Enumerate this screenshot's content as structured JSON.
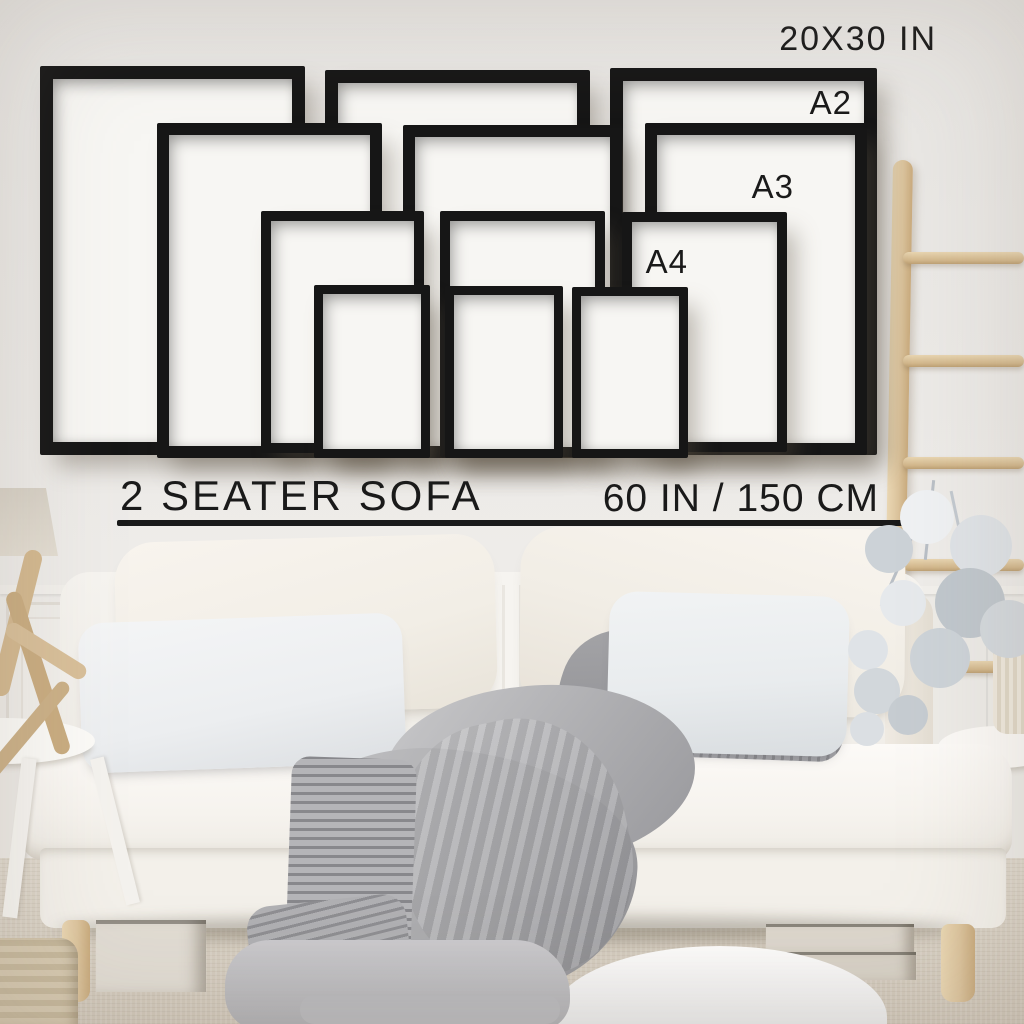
{
  "labels": {
    "frame_size_top": "20X30 IN",
    "a2": "A2",
    "a3": "A3",
    "a4": "A4",
    "sofa_caption": "2 SEATER SOFA",
    "sofa_width_caption": "60 IN / 150 CM"
  },
  "frames": [
    {
      "size": "20x30",
      "x": 40,
      "y": 66,
      "w": 265,
      "h": 389,
      "border": 13
    },
    {
      "size": "20x30",
      "x": 325,
      "y": 70,
      "w": 265,
      "h": 385,
      "border": 13
    },
    {
      "size": "20x30",
      "x": 610,
      "y": 68,
      "w": 267,
      "h": 387,
      "border": 13
    },
    {
      "size": "A2",
      "x": 157,
      "y": 123,
      "w": 225,
      "h": 335,
      "border": 12
    },
    {
      "size": "A2",
      "x": 403,
      "y": 125,
      "w": 219,
      "h": 333,
      "border": 12
    },
    {
      "size": "A2",
      "x": 645,
      "y": 123,
      "w": 222,
      "h": 332,
      "border": 12
    },
    {
      "size": "A3",
      "x": 261,
      "y": 211,
      "w": 163,
      "h": 242,
      "border": 10
    },
    {
      "size": "A3",
      "x": 440,
      "y": 211,
      "w": 165,
      "h": 246,
      "border": 10
    },
    {
      "size": "A3",
      "x": 622,
      "y": 212,
      "w": 165,
      "h": 240,
      "border": 10
    },
    {
      "size": "A4",
      "x": 314,
      "y": 285,
      "w": 116,
      "h": 173,
      "border": 9
    },
    {
      "size": "A4",
      "x": 445,
      "y": 286,
      "w": 118,
      "h": 172,
      "border": 9
    },
    {
      "size": "A4",
      "x": 572,
      "y": 287,
      "w": 116,
      "h": 171,
      "border": 9
    }
  ],
  "colors": {
    "ink": "#1a1a1a",
    "frame": "#161616",
    "mat": "#f7f6f3",
    "wall": "#ebe9e6",
    "wood": "#dcc49d",
    "sofa": "#f7f5f1",
    "blanket": "#b2b2b5",
    "carpet": "#d8d1c4"
  }
}
